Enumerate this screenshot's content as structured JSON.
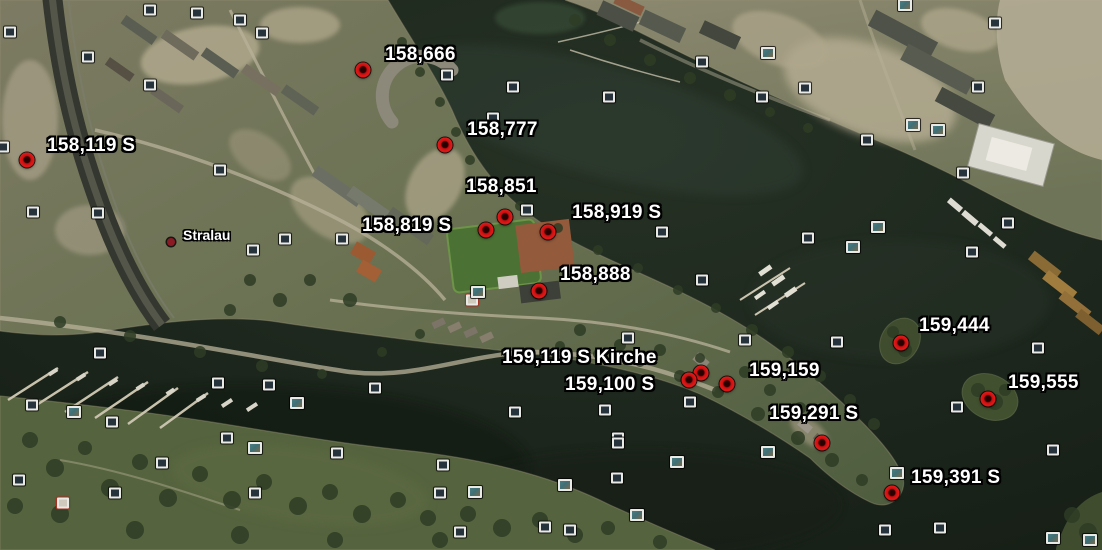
{
  "map": {
    "description": "satellite-aerial-view-stralau-peninsula",
    "place_labels": [
      {
        "label": "Stralau",
        "dot_x": 171,
        "dot_y": 242,
        "text_x": 183,
        "text_y": 228
      }
    ],
    "placemarks": [
      {
        "label": "158,119 S",
        "marker_x": 27,
        "marker_y": 160,
        "label_x": 47,
        "label_y": 136
      },
      {
        "label": "158,666",
        "marker_x": 363,
        "marker_y": 70,
        "label_x": 385,
        "label_y": 45
      },
      {
        "label": "158,777",
        "marker_x": 445,
        "marker_y": 145,
        "label_x": 467,
        "label_y": 120
      },
      {
        "label": "158,851",
        "marker_x": 505,
        "marker_y": 217,
        "label_x": 466,
        "label_y": 177
      },
      {
        "label": "158,819 S",
        "marker_x": 486,
        "marker_y": 230,
        "label_x": 362,
        "label_y": 216
      },
      {
        "label": "158,919 S",
        "marker_x": 548,
        "marker_y": 232,
        "label_x": 572,
        "label_y": 203
      },
      {
        "label": "158,888",
        "marker_x": 539,
        "marker_y": 291,
        "label_x": 560,
        "label_y": 265
      },
      {
        "label": "159,119 S Kirche",
        "marker_x": 701,
        "marker_y": 373,
        "label_x": 502,
        "label_y": 348
      },
      {
        "label": "159,100 S",
        "marker_x": 689,
        "marker_y": 380,
        "label_x": 565,
        "label_y": 375
      },
      {
        "label": "159,159",
        "marker_x": 727,
        "marker_y": 384,
        "label_x": 749,
        "label_y": 361
      },
      {
        "label": "159,291 S",
        "marker_x": 822,
        "marker_y": 443,
        "label_x": 769,
        "label_y": 404
      },
      {
        "label": "159,391 S",
        "marker_x": 892,
        "marker_y": 493,
        "label_x": 911,
        "label_y": 468
      },
      {
        "label": "159,444",
        "marker_x": 901,
        "marker_y": 343,
        "label_x": 919,
        "label_y": 316
      },
      {
        "label": "159,555",
        "marker_x": 988,
        "marker_y": 399,
        "label_x": 1008,
        "label_y": 373
      }
    ],
    "photo_icons": [
      {
        "x": 10,
        "y": 32,
        "v": "dark"
      },
      {
        "x": 150,
        "y": 10,
        "v": "dark"
      },
      {
        "x": 197,
        "y": 13,
        "v": "dark"
      },
      {
        "x": 240,
        "y": 20,
        "v": "dark"
      },
      {
        "x": 262,
        "y": 33,
        "v": "dark"
      },
      {
        "x": 88,
        "y": 57,
        "v": "dark"
      },
      {
        "x": 150,
        "y": 85,
        "v": "dark"
      },
      {
        "x": 3,
        "y": 147,
        "v": "dark"
      },
      {
        "x": 220,
        "y": 170,
        "v": "dark"
      },
      {
        "x": 33,
        "y": 212,
        "v": "dark"
      },
      {
        "x": 98,
        "y": 213,
        "v": "dark"
      },
      {
        "x": 253,
        "y": 250,
        "v": "dark"
      },
      {
        "x": 285,
        "y": 239,
        "v": "dark"
      },
      {
        "x": 342,
        "y": 239,
        "v": "dark"
      },
      {
        "x": 447,
        "y": 75,
        "v": "dark"
      },
      {
        "x": 513,
        "y": 87,
        "v": "dark"
      },
      {
        "x": 493,
        "y": 118,
        "v": "dark"
      },
      {
        "x": 609,
        "y": 97,
        "v": "dark"
      },
      {
        "x": 702,
        "y": 62,
        "v": "dark"
      },
      {
        "x": 768,
        "y": 53,
        "v": "photo"
      },
      {
        "x": 762,
        "y": 97,
        "v": "dark"
      },
      {
        "x": 805,
        "y": 88,
        "v": "dark"
      },
      {
        "x": 867,
        "y": 140,
        "v": "dark"
      },
      {
        "x": 905,
        "y": 5,
        "v": "photo"
      },
      {
        "x": 995,
        "y": 23,
        "v": "dark"
      },
      {
        "x": 978,
        "y": 87,
        "v": "dark"
      },
      {
        "x": 913,
        "y": 125,
        "v": "photo"
      },
      {
        "x": 938,
        "y": 130,
        "v": "photo"
      },
      {
        "x": 963,
        "y": 173,
        "v": "dark"
      },
      {
        "x": 1008,
        "y": 223,
        "v": "dark"
      },
      {
        "x": 972,
        "y": 252,
        "v": "dark"
      },
      {
        "x": 878,
        "y": 227,
        "v": "photo"
      },
      {
        "x": 527,
        "y": 210,
        "v": "dark"
      },
      {
        "x": 662,
        "y": 232,
        "v": "dark"
      },
      {
        "x": 808,
        "y": 238,
        "v": "dark"
      },
      {
        "x": 853,
        "y": 247,
        "v": "photo"
      },
      {
        "x": 702,
        "y": 280,
        "v": "dark"
      },
      {
        "x": 745,
        "y": 340,
        "v": "dark"
      },
      {
        "x": 837,
        "y": 342,
        "v": "dark"
      },
      {
        "x": 472,
        "y": 300,
        "v": "red-frame"
      },
      {
        "x": 478,
        "y": 292,
        "v": "photo"
      },
      {
        "x": 628,
        "y": 338,
        "v": "dark"
      },
      {
        "x": 690,
        "y": 402,
        "v": "dark"
      },
      {
        "x": 515,
        "y": 412,
        "v": "dark"
      },
      {
        "x": 605,
        "y": 410,
        "v": "dark"
      },
      {
        "x": 618,
        "y": 438,
        "v": "dark"
      },
      {
        "x": 100,
        "y": 353,
        "v": "dark"
      },
      {
        "x": 218,
        "y": 383,
        "v": "dark"
      },
      {
        "x": 269,
        "y": 385,
        "v": "dark"
      },
      {
        "x": 375,
        "y": 388,
        "v": "dark"
      },
      {
        "x": 297,
        "y": 403,
        "v": "photo"
      },
      {
        "x": 32,
        "y": 405,
        "v": "dark"
      },
      {
        "x": 74,
        "y": 412,
        "v": "photo"
      },
      {
        "x": 112,
        "y": 422,
        "v": "dark"
      },
      {
        "x": 162,
        "y": 463,
        "v": "dark"
      },
      {
        "x": 115,
        "y": 493,
        "v": "dark"
      },
      {
        "x": 63,
        "y": 503,
        "v": "red-frame"
      },
      {
        "x": 19,
        "y": 480,
        "v": "dark"
      },
      {
        "x": 227,
        "y": 438,
        "v": "dark"
      },
      {
        "x": 255,
        "y": 448,
        "v": "photo"
      },
      {
        "x": 255,
        "y": 493,
        "v": "dark"
      },
      {
        "x": 337,
        "y": 453,
        "v": "dark"
      },
      {
        "x": 443,
        "y": 465,
        "v": "dark"
      },
      {
        "x": 475,
        "y": 492,
        "v": "photo"
      },
      {
        "x": 440,
        "y": 493,
        "v": "dark"
      },
      {
        "x": 460,
        "y": 532,
        "v": "dark"
      },
      {
        "x": 545,
        "y": 527,
        "v": "dark"
      },
      {
        "x": 570,
        "y": 530,
        "v": "dark"
      },
      {
        "x": 565,
        "y": 485,
        "v": "photo"
      },
      {
        "x": 618,
        "y": 443,
        "v": "dark"
      },
      {
        "x": 617,
        "y": 478,
        "v": "dark"
      },
      {
        "x": 637,
        "y": 515,
        "v": "photo"
      },
      {
        "x": 677,
        "y": 462,
        "v": "photo"
      },
      {
        "x": 768,
        "y": 452,
        "v": "photo"
      },
      {
        "x": 957,
        "y": 407,
        "v": "dark"
      },
      {
        "x": 897,
        "y": 473,
        "v": "photo"
      },
      {
        "x": 1038,
        "y": 348,
        "v": "dark"
      },
      {
        "x": 1053,
        "y": 450,
        "v": "dark"
      },
      {
        "x": 885,
        "y": 530,
        "v": "dark"
      },
      {
        "x": 940,
        "y": 528,
        "v": "dark"
      },
      {
        "x": 1053,
        "y": 538,
        "v": "photo"
      },
      {
        "x": 1090,
        "y": 540,
        "v": "photo"
      }
    ],
    "colors": {
      "water": "#1d271d",
      "water_deep": "#131a12",
      "water_light": "#2e3b2e",
      "land_green": "#66704f",
      "land_pale": "#b3ab93",
      "tree_green": "#2e3c24",
      "field_green": "#4c7134",
      "clay_field": "#935a3b",
      "marker_red": "#d01717",
      "marker_core": "#2a0000",
      "label_text": "#ffffff",
      "label_outline": "#000000",
      "icon_frame": "#e9e9e5",
      "icon_screen_dark": "#26333d",
      "icon_screen_photo": "#3f7076",
      "icon_red_frame": "#a83222",
      "place_dot": "#8a1a24"
    }
  }
}
